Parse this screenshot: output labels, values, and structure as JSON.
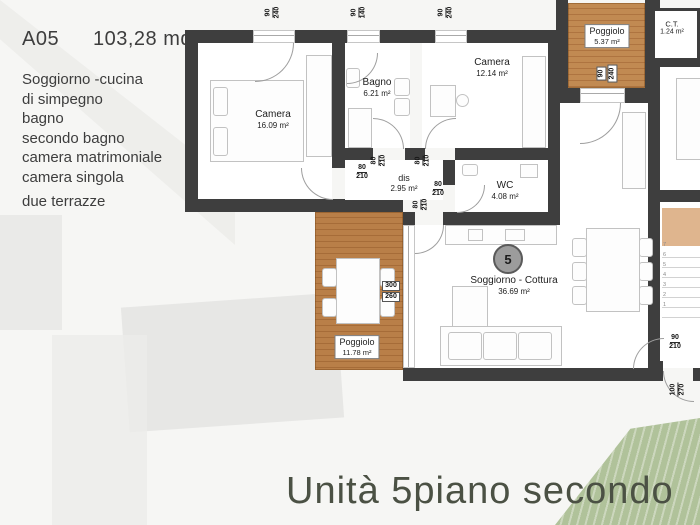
{
  "panel": {
    "unit_code": "A05",
    "unit_area": "103,28 mq",
    "features": [
      "Soggiorno -cucina",
      "di simpegno",
      "bagno",
      "secondo bagno",
      "camera matrimoniale",
      "camera singola",
      "due terrazze"
    ]
  },
  "title": "Unità 5piano secondo",
  "badge": "5",
  "rooms": {
    "camera1": {
      "name": "Camera",
      "area": "16.09 m²"
    },
    "bagno": {
      "name": "Bagno",
      "area": "6.21 m²"
    },
    "camera2": {
      "name": "Camera",
      "area": "12.14 m²"
    },
    "dis": {
      "name": "dis",
      "area": "2.95 m²"
    },
    "wc": {
      "name": "WC",
      "area": "4.08 m²"
    },
    "soggiorno": {
      "name": "Soggiorno - Cottura",
      "area": "36.69 m²"
    },
    "poggiolo_large": {
      "name": "Poggiolo",
      "area": "11.78 m²"
    },
    "poggiolo_small": {
      "name": "Poggiolo",
      "area": "5.37 m²"
    },
    "ct": {
      "name": "C.T.",
      "area": "1.24 m²"
    }
  },
  "dims": {
    "win_camera1": {
      "w": "90",
      "h": "240"
    },
    "win_bagno": {
      "w": "90",
      "h": "140"
    },
    "win_camera2": {
      "w": "90",
      "h": "240"
    },
    "door_poggiolo_small": {
      "w": "90",
      "h": "240"
    },
    "win_soggiorno": {
      "w": "300",
      "h": "260"
    },
    "door_interior": {
      "w": "80",
      "h": "210"
    },
    "door_entry": {
      "w": "90",
      "h": "210"
    },
    "door_stairwell": {
      "w": "100",
      "h": "270"
    }
  },
  "stairs": {
    "steps": [
      "7",
      "6",
      "5",
      "4",
      "3",
      "2",
      "1"
    ]
  },
  "colors": {
    "wall": "#3e3e3e",
    "wood": "#b5793f",
    "wood_light": "#c18a52",
    "landing": "#dfb58e",
    "green": "#a3b98a",
    "title_text": "#4b5144"
  }
}
